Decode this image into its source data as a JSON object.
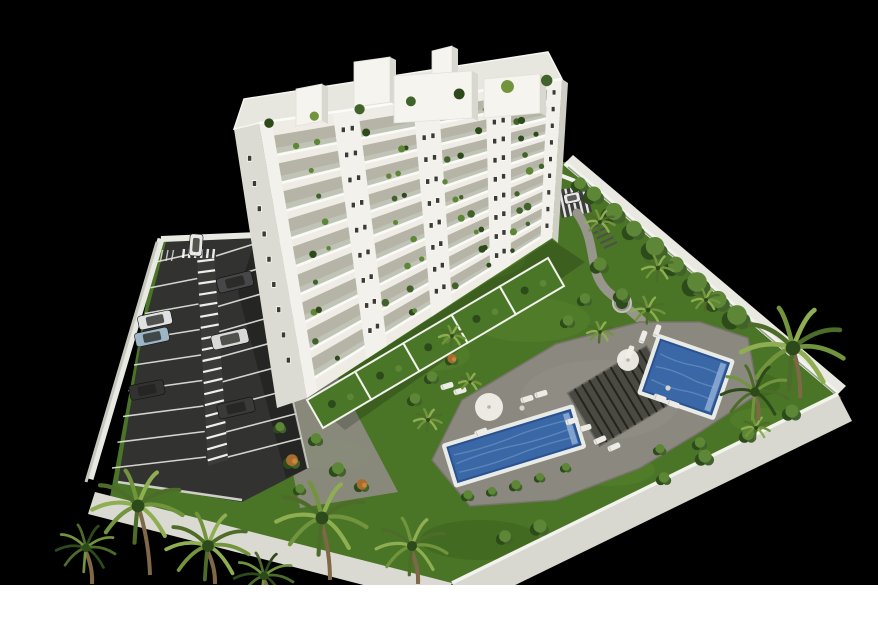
{
  "meta": {
    "title": "3D aerial architectural rendering of a white apartment building with garden, two swimming pools, sun deck, pergola and gated parking lot on a black background",
    "type": "architectural-render",
    "visible_text": ""
  },
  "canvas": {
    "width": 878,
    "height": 640,
    "render_area": {
      "x": 0,
      "y": 0,
      "width": 878,
      "height": 585
    },
    "background": "#000000",
    "page_background": "#ffffff"
  },
  "palette": {
    "black": "#000000",
    "white": "#ffffff",
    "lawn": "#4a7526",
    "lawnLight": "#6d9a38",
    "lawnDark": "#2a4a14",
    "wallTop": "#f3f3ee",
    "wallFaceSE": "#d8d8d1",
    "wallFaceNE": "#e9e9e2",
    "wallGray": "#c6c6bf",
    "asphalt": "#323231",
    "lineWhite": "#e6e6e0",
    "pavement": "#8d8b81",
    "path": "#98968c",
    "deck": "#8b897f",
    "deckEdge": "#76746b",
    "coping": "#e9ebe7",
    "water": "#3a67a5",
    "waterLight": "#7099ca",
    "waterDark": "#2b5190",
    "poolStep": "#93b2d8",
    "pergola": "#45443e",
    "pergolaSlat": "#24241f",
    "lounger": "#edebe5",
    "parasol": "#f1efe8",
    "bldgFront": "#eeece5",
    "bldgLeft": "#dbdbd3",
    "bldgRight": "#cecec5",
    "pier": "#f2f1eb",
    "slab": "#fafaf6",
    "recess": "#aeac9e",
    "glass": "#c9d1c2",
    "window": "#3b3b33",
    "roof": "#e7e7e0",
    "box": "#f5f4ef",
    "boxSide": "#d8d8d0",
    "plant": "#41632b",
    "plantLight": "#5d8637",
    "plantDark": "#2d4a1b",
    "palm": "#71943d",
    "palmLight": "#8fae52",
    "palmDark": "#4e6c29",
    "trunk": "#7e6848",
    "orangeBush": "#a86c30",
    "carGlass": "#22221f"
  },
  "scene": {
    "lawn": {
      "poly": [
        [
          264,
          236
        ],
        [
          264,
          168
        ],
        [
          565,
          162
        ],
        [
          838,
          394
        ],
        [
          452,
          583
        ],
        [
          110,
          497
        ],
        [
          158,
          238
        ]
      ],
      "light": [
        [
          470,
          260,
          55,
          20
        ],
        [
          530,
          320,
          60,
          22
        ],
        [
          430,
          355,
          40,
          16
        ],
        [
          690,
          390,
          50,
          18
        ],
        [
          610,
          470,
          45,
          16
        ],
        [
          330,
          455,
          40,
          15
        ],
        [
          760,
          420,
          30,
          12
        ]
      ],
      "dark": [
        [
          360,
          305,
          45,
          16
        ],
        [
          565,
          435,
          50,
          18
        ],
        [
          745,
          385,
          35,
          14
        ],
        [
          480,
          540,
          60,
          20
        ]
      ]
    },
    "walls": {
      "ne": {
        "a": [
          565,
          163
        ],
        "b": [
          838,
          394
        ],
        "face": [
          [
            565,
            163
          ],
          [
            838,
            394
          ],
          [
            846,
            386
          ],
          [
            573,
            155
          ]
        ],
        "topW": 5
      },
      "se": {
        "top": [
          [
            838,
            394
          ],
          [
            452,
            583
          ]
        ],
        "face": [
          [
            838,
            394
          ],
          [
            452,
            583
          ],
          [
            464,
            610
          ],
          [
            852,
            421
          ]
        ]
      },
      "sw": {
        "face": [
          [
            452,
            583
          ],
          [
            95,
            492
          ],
          [
            88,
            514
          ],
          [
            445,
            606
          ]
        ]
      }
    },
    "parking": {
      "asphalt": [
        [
          166,
          242
        ],
        [
          256,
          238
        ],
        [
          308,
          468
        ],
        [
          242,
          502
        ],
        [
          118,
          482
        ],
        [
          143,
          330
        ]
      ],
      "shadow": [
        [
          256,
          238
        ],
        [
          308,
          468
        ],
        [
          286,
          478
        ],
        [
          238,
          292
        ]
      ],
      "leftWall": [
        [
          161,
          239
        ],
        [
          90,
          479
        ]
      ],
      "topWall": [
        [
          161,
          239
        ],
        [
          257,
          235
        ]
      ],
      "curb": [
        [
          118,
          482
        ],
        [
          242,
          500
        ]
      ],
      "rightCurb": [
        [
          256,
          238
        ],
        [
          308,
          468
        ]
      ],
      "hatch": {
        "poly": [
          [
            197,
            256
          ],
          [
            214,
            254
          ],
          [
            228,
            460
          ],
          [
            208,
            466
          ]
        ],
        "rungs": 19
      },
      "stalls": {
        "left": {
          "outTop": [
            156,
            262
          ],
          "outBot": [
            112,
            468
          ],
          "inTop": [
            196,
            258
          ],
          "inBot": [
            206,
            462
          ],
          "n": 8,
          "lift": 5
        },
        "right": {
          "inTop": [
            216,
            256
          ],
          "inBot": [
            224,
            458
          ],
          "outTop": [
            254,
            250
          ],
          "outBot": [
            302,
            444
          ],
          "n": 8,
          "lift": 6
        }
      },
      "zebraTop": {
        "x0": 184,
        "x1": 214,
        "y": 249,
        "h": 9,
        "n": 6
      },
      "motoMarks": {
        "x0": 157,
        "y0": 250,
        "n": 4,
        "dx": 5.5,
        "len": 11
      },
      "cars": [
        {
          "x": 196,
          "y": 245,
          "w": 13,
          "h": 22,
          "rot": 4,
          "color": "#e9e9e7"
        },
        {
          "x": 235,
          "y": 282,
          "w": 36,
          "h": 15,
          "rot": -14,
          "color": "#47474a"
        },
        {
          "x": 155,
          "y": 320,
          "w": 34,
          "h": 14,
          "rot": -12,
          "color": "#dfe1e2"
        },
        {
          "x": 152,
          "y": 337,
          "w": 34,
          "h": 14,
          "rot": -12,
          "color": "#9db6c6"
        },
        {
          "x": 230,
          "y": 339,
          "w": 37,
          "h": 15,
          "rot": -13,
          "color": "#d9d9d7"
        },
        {
          "x": 147,
          "y": 390,
          "w": 35,
          "h": 15,
          "rot": -11,
          "color": "#323231"
        },
        {
          "x": 236,
          "y": 408,
          "w": 37,
          "h": 15,
          "rot": -13,
          "color": "#3a3a39"
        }
      ]
    },
    "pavementStrip": {
      "poly": [
        [
          262,
          320
        ],
        [
          318,
          340
        ],
        [
          398,
          492
        ],
        [
          300,
          508
        ],
        [
          282,
          420
        ]
      ]
    },
    "entrance": {
      "pav": [
        [
          556,
          190
        ],
        [
          586,
          186
        ],
        [
          592,
          212
        ],
        [
          562,
          218
        ]
      ],
      "zebraN": 5,
      "car": {
        "x": 572,
        "y": 198,
        "w": 10,
        "h": 16,
        "rot": 78,
        "color": "#e8e8e6"
      },
      "steps": {
        "x": 586,
        "y": 224,
        "n": 6,
        "dx": 3.6,
        "dy": 4.8,
        "len": 13
      },
      "stub": [
        [
          552,
          172
        ],
        [
          588,
          186
        ]
      ]
    },
    "path": {
      "d": "M 577 213 C 600 245 585 275 612 295 C 632 312 642 320 658 336",
      "width": 9,
      "planter": {
        "cx": 622,
        "cy": 303,
        "r": 9
      }
    },
    "deck": {
      "poly": [
        [
          556,
          344
        ],
        [
          640,
          322
        ],
        [
          700,
          322
        ],
        [
          748,
          338
        ],
        [
          758,
          394
        ],
        [
          700,
          432
        ],
        [
          640,
          468
        ],
        [
          556,
          500
        ],
        [
          470,
          506
        ],
        [
          432,
          460
        ],
        [
          462,
          400
        ]
      ]
    },
    "pergola": {
      "cx": 623,
      "cy": 396,
      "w": 92,
      "h": 62,
      "rot": -31,
      "slats": 11
    },
    "pools": [
      {
        "name": "upper-pool",
        "cx": 686,
        "cy": 377,
        "w": 72,
        "h": 54,
        "rot": 19
      },
      {
        "name": "lower-pool",
        "cx": 514,
        "cy": 446,
        "w": 128,
        "h": 36,
        "rot": -17
      }
    ],
    "loungers": [
      [
        643,
        337,
        -70
      ],
      [
        657,
        331,
        -70
      ],
      [
        630,
        352,
        -70
      ],
      [
        660,
        398,
        20
      ],
      [
        673,
        404,
        20
      ],
      [
        527,
        399,
        -17
      ],
      [
        541,
        394,
        -17
      ],
      [
        572,
        421,
        -17
      ],
      [
        585,
        428,
        -17
      ],
      [
        447,
        386,
        -17
      ],
      [
        460,
        391,
        -17
      ],
      [
        600,
        440,
        -24
      ],
      [
        614,
        447,
        -24
      ],
      [
        481,
        432,
        -20
      ]
    ],
    "parasols": [
      [
        489,
        407,
        14
      ],
      [
        628,
        360,
        11
      ]
    ],
    "tables": [
      [
        522,
        408
      ],
      [
        668,
        388
      ]
    ],
    "building": {
      "front": {
        "tl": [
          259,
          123
        ],
        "tr": [
          562,
          79
        ],
        "br": [
          552,
          238
        ],
        "bl": [
          307,
          398
        ]
      },
      "leftFace": {
        "lt": [
          234,
          129
        ],
        "lb": [
          277,
          408
        ]
      },
      "leftWindows": {
        "top": [
          246,
          140
        ],
        "bot": [
          293,
          385
        ],
        "n": 9
      },
      "rightFace": [
        [
          562,
          79
        ],
        [
          568,
          83
        ],
        [
          558,
          243
        ],
        [
          552,
          238
        ]
      ],
      "roofPoly": [
        [
          234,
          129
        ],
        [
          259,
          123
        ],
        [
          562,
          79
        ],
        [
          548,
          52
        ],
        [
          244,
          99
        ]
      ],
      "floorsT": [
        0.125,
        0.228,
        0.331,
        0.434,
        0.537,
        0.64,
        0.743,
        0.846,
        0.949
      ],
      "recess": 0.072,
      "glass": 0.026,
      "piers": {
        "mids": [
          0.285,
          0.55,
          0.79
        ],
        "halfw": 0.042,
        "edges": [
          [
            0.0,
            0.042
          ],
          [
            0.952,
            1.0
          ]
        ]
      },
      "bays": [
        [
          0.05,
          0.24
        ],
        [
          0.33,
          0.505
        ],
        [
          0.595,
          0.745
        ],
        [
          0.835,
          0.945
        ]
      ],
      "boxes": [
        {
          "x": 432,
          "y": 46,
          "w": 20,
          "h": 40
        },
        {
          "x": 354,
          "y": 57,
          "w": 36,
          "h": 50
        },
        {
          "x": 296,
          "y": 84,
          "w": 26,
          "h": 42
        },
        {
          "x": 394,
          "y": 71,
          "w": 78,
          "h": 52
        },
        {
          "x": 484,
          "y": 74,
          "w": 56,
          "h": 44
        }
      ],
      "roofPlantsU": [
        0.03,
        0.18,
        0.33,
        0.5,
        0.66,
        0.82,
        0.95
      ],
      "terraces": {
        "a": [
          307,
          400
        ],
        "b": [
          548,
          258
        ],
        "segs": 5,
        "off": [
          16,
          28
        ]
      }
    },
    "veg": {
      "neHedge": [
        [
          594,
          196,
          11
        ],
        [
          614,
          214,
          13
        ],
        [
          634,
          231,
          12
        ],
        [
          655,
          249,
          14
        ],
        [
          676,
          267,
          12
        ],
        [
          697,
          285,
          15
        ],
        [
          718,
          302,
          13
        ],
        [
          737,
          318,
          15
        ],
        [
          580,
          185,
          9
        ]
      ],
      "neTrees": [
        [
          600,
          222,
          15
        ],
        [
          658,
          268,
          16
        ],
        [
          706,
          300,
          14
        ]
      ],
      "seHedge": [
        [
          792,
          413,
          10
        ],
        [
          748,
          436,
          9
        ],
        [
          705,
          458,
          10
        ],
        [
          664,
          479,
          8
        ],
        [
          540,
          528,
          10
        ],
        [
          505,
          538,
          9
        ]
      ],
      "poolHedge": [
        [
          468,
          496,
          7
        ],
        [
          492,
          492,
          6
        ],
        [
          516,
          486,
          7
        ],
        [
          540,
          478,
          6
        ],
        [
          566,
          468,
          6
        ]
      ],
      "pavementBushes": [
        [
          292,
          462,
          9,
          1
        ],
        [
          316,
          440,
          8,
          0
        ],
        [
          338,
          470,
          9,
          0
        ],
        [
          362,
          486,
          8,
          1
        ],
        [
          280,
          428,
          7,
          0
        ],
        [
          300,
          490,
          7,
          0
        ]
      ],
      "lawnBushes": [
        [
          600,
          266,
          10,
          0
        ],
        [
          585,
          300,
          8,
          0
        ],
        [
          622,
          296,
          9,
          0
        ],
        [
          568,
          322,
          8,
          0
        ],
        [
          432,
          378,
          8,
          0
        ],
        [
          452,
          360,
          7,
          1
        ],
        [
          415,
          400,
          8,
          0
        ],
        [
          660,
          450,
          7,
          0
        ],
        [
          700,
          444,
          8,
          0
        ]
      ],
      "smallPalms": [
        [
          648,
          310,
          17
        ],
        [
          600,
          332,
          13
        ],
        [
          756,
          428,
          14
        ],
        [
          452,
          336,
          13
        ],
        [
          428,
          420,
          14
        ],
        [
          470,
          382,
          11
        ]
      ],
      "bigPalms": [
        {
          "cx": 793,
          "cy": 348,
          "r": 52,
          "trunk": [
            [
              800,
              398
            ],
            [
              794,
              352
            ]
          ]
        },
        {
          "cx": 755,
          "cy": 392,
          "r": 34,
          "trunk": [
            [
              758,
              420
            ],
            [
              755,
              396
            ]
          ],
          "dark": true
        },
        {
          "cx": 138,
          "cy": 506,
          "r": 46,
          "trunk": [
            [
              150,
              575
            ],
            [
              140,
              512
            ]
          ]
        },
        {
          "cx": 208,
          "cy": 546,
          "r": 42,
          "trunk": [
            [
              215,
              584
            ],
            [
              208,
              552
            ]
          ]
        },
        {
          "cx": 322,
          "cy": 518,
          "r": 46,
          "trunk": [
            [
              330,
              580
            ],
            [
              322,
              524
            ]
          ]
        },
        {
          "cx": 412,
          "cy": 546,
          "r": 36,
          "trunk": [
            [
              418,
              584
            ],
            [
              412,
              552
            ]
          ]
        },
        {
          "cx": 86,
          "cy": 548,
          "r": 30,
          "trunk": [
            [
              92,
              584
            ],
            [
              86,
              552
            ]
          ],
          "dark": true
        },
        {
          "cx": 264,
          "cy": 576,
          "r": 30,
          "trunk": [
            [
              268,
              600
            ],
            [
              264,
              580
            ]
          ],
          "dark": true
        }
      ]
    }
  }
}
